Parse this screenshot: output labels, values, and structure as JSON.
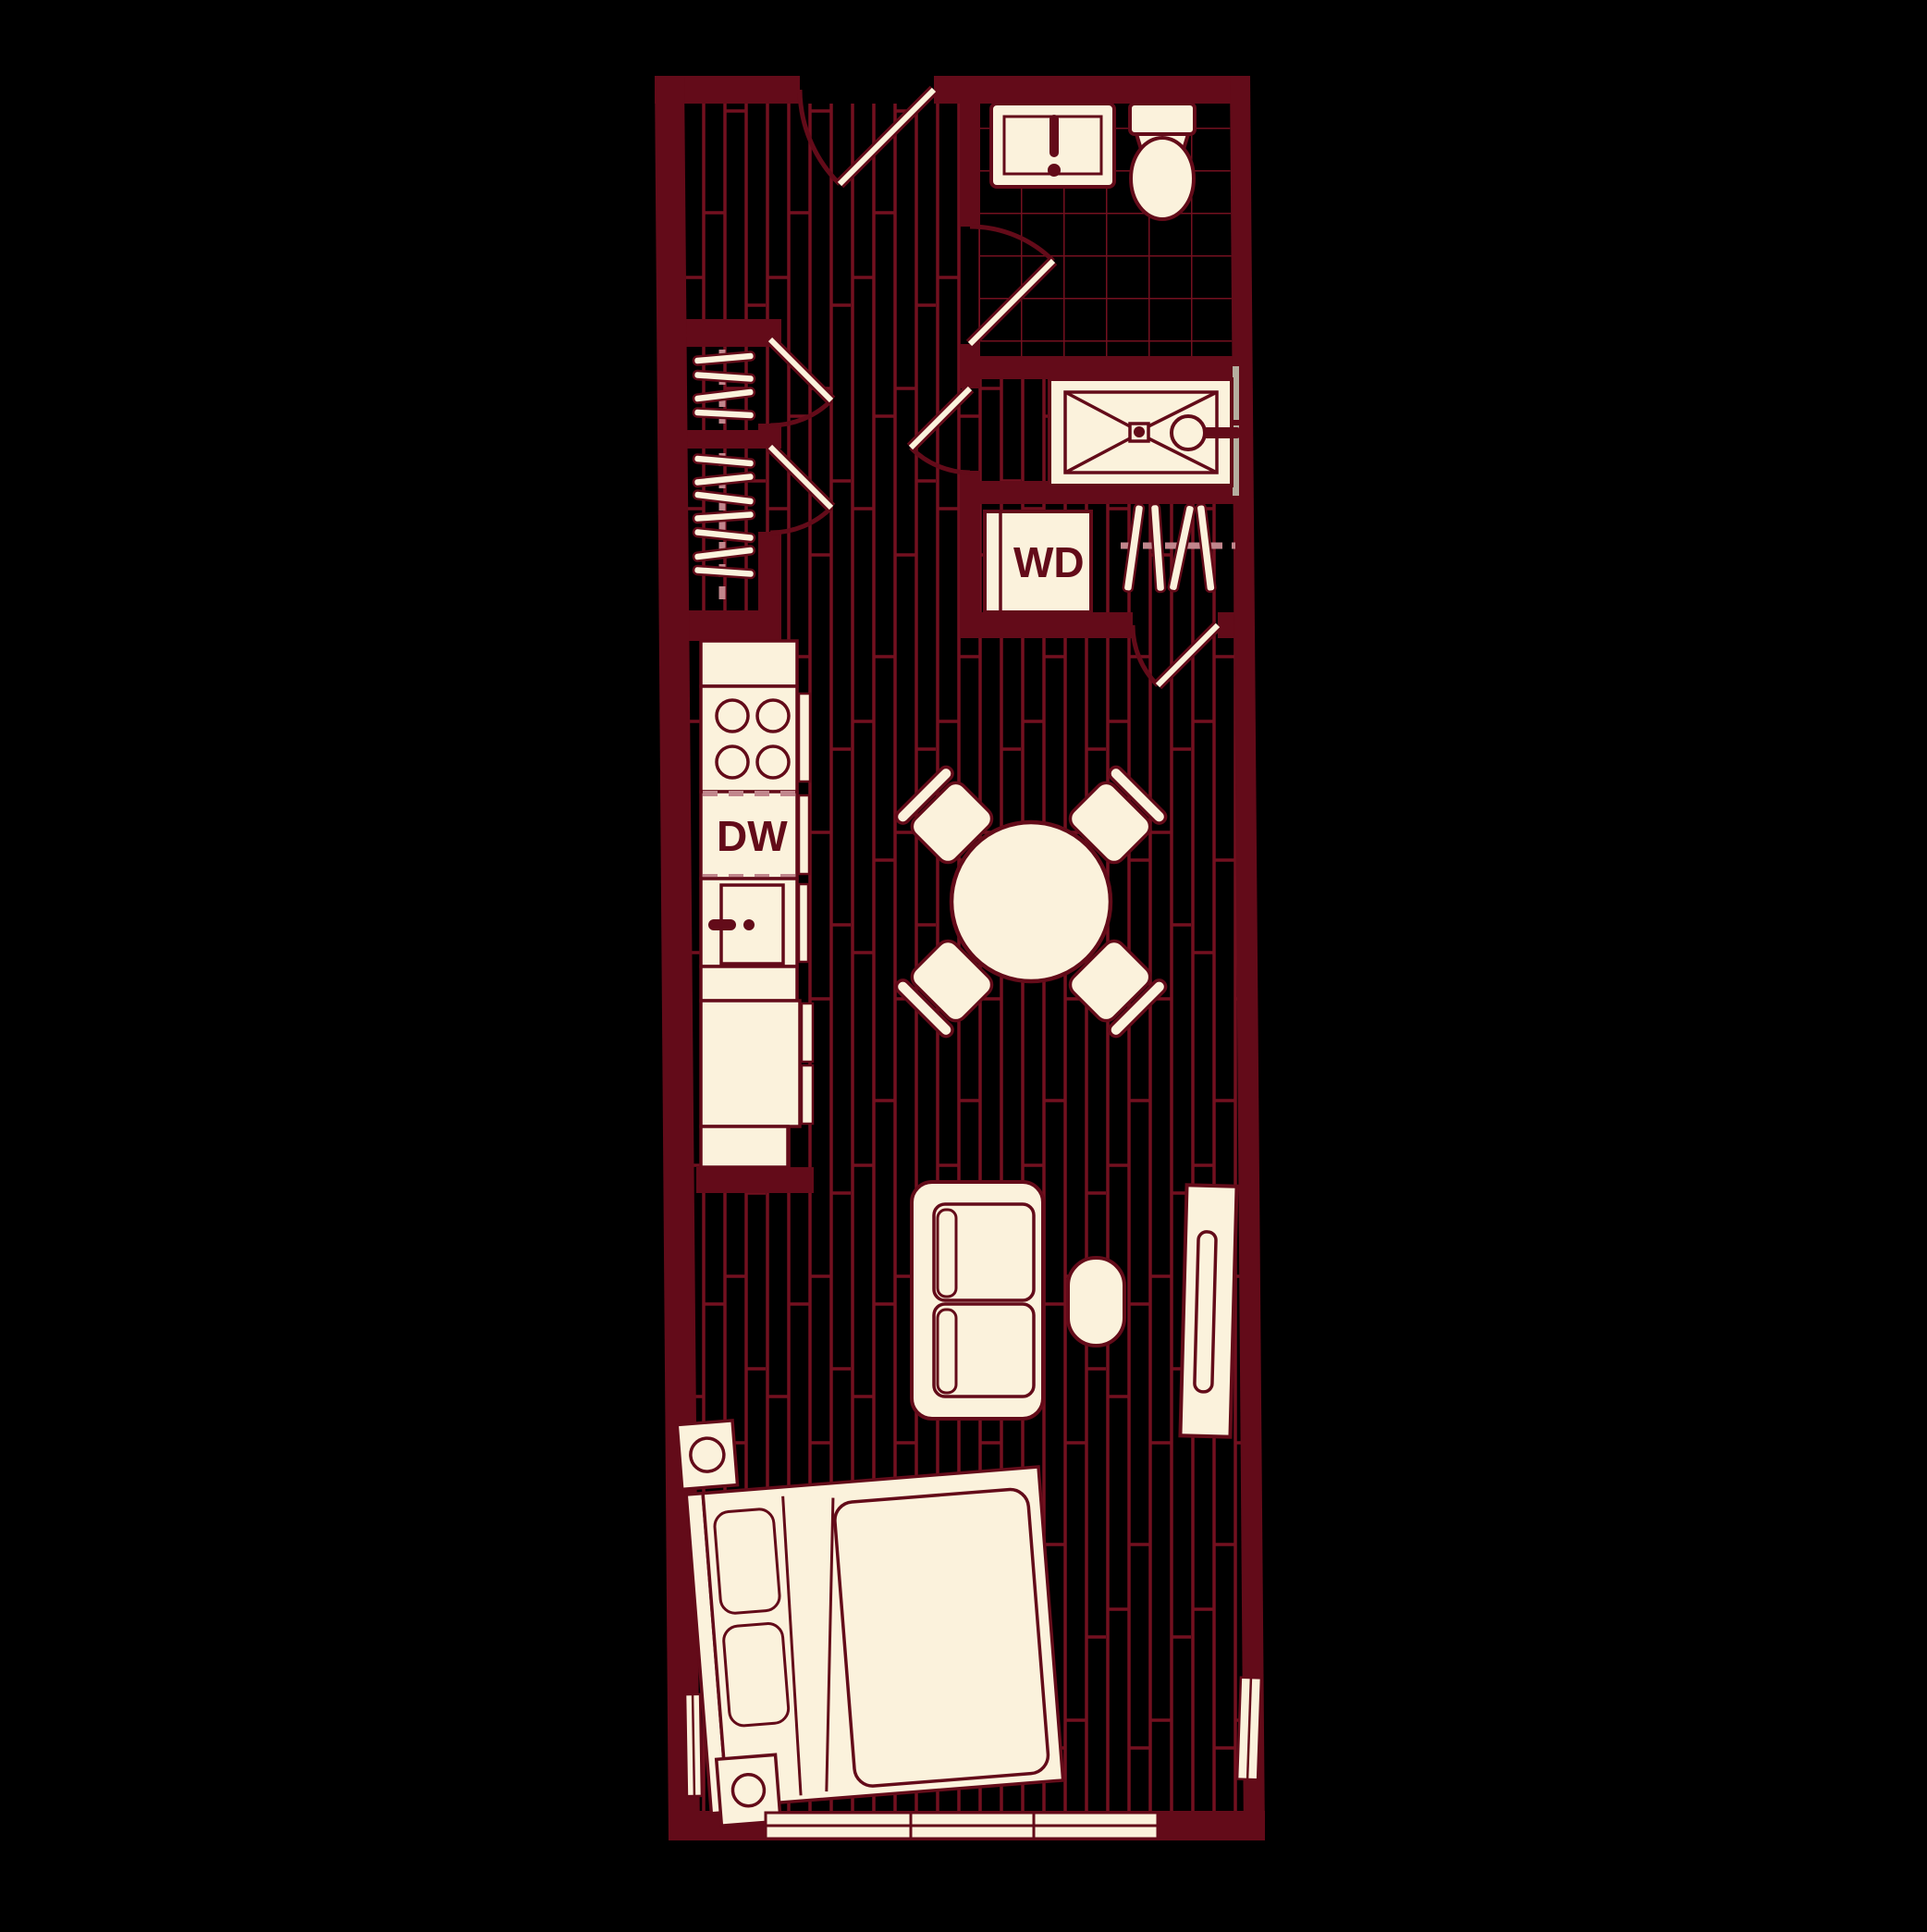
{
  "labels": {
    "washer_dryer": "WD",
    "dishwasher": "DW"
  },
  "colors": {
    "background": "#000000",
    "wall": "#630B19",
    "line": "#73101F",
    "cream": "#FBF2DC",
    "rod": "#C1868C",
    "glass": "#B5AE9F"
  },
  "plan": {
    "type": "studio-apartment-floor-plan",
    "rooms": [
      "entry-hall",
      "bathroom",
      "shower-room",
      "laundry-closet",
      "closet-upper",
      "closet-lower",
      "kitchen",
      "dining-area",
      "living-area",
      "sleeping-area"
    ],
    "fixtures": [
      "entry-door",
      "bathroom-vanity-sink",
      "toilet",
      "shower",
      "washer-dryer-unit",
      "hanging-rods",
      "range-stove",
      "dishwasher",
      "kitchen-sink",
      "refrigerator",
      "round-dining-table",
      "dining-chairs",
      "loveseat-sofa",
      "ottoman",
      "tv-console",
      "bed",
      "nightstands",
      "windows"
    ]
  }
}
